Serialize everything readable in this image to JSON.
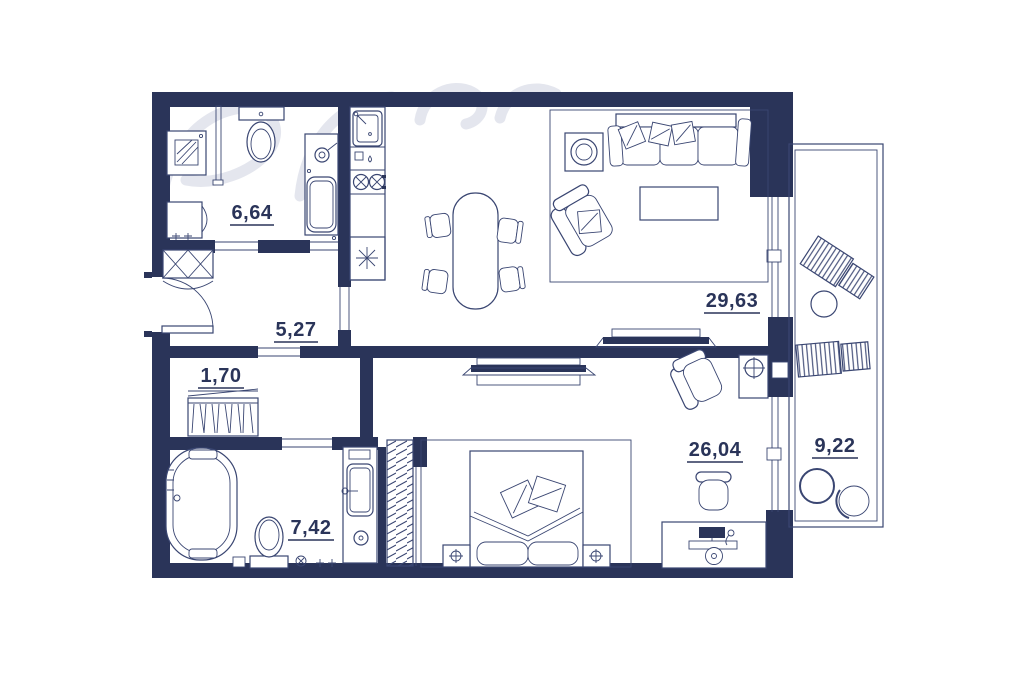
{
  "plan": {
    "title": "apartment-floor-plan",
    "units": "m2",
    "colors": {
      "wall": "#2a3459",
      "line": "#3a4672",
      "label": "#2a3459",
      "watermark": "#c9cedd",
      "background": "#ffffff"
    },
    "rooms": [
      {
        "name": "bathroom-small",
        "area": "6,64",
        "furniture": [
          "washing-machine",
          "toilet",
          "sink-vanity",
          "cabinet"
        ]
      },
      {
        "name": "hallway",
        "area": "5,27",
        "furniture": [
          "shoe-cabinet",
          "entrance-door"
        ]
      },
      {
        "name": "wardrobe-closet",
        "area": "1,70",
        "furniture": [
          "wardrobe-hangers"
        ]
      },
      {
        "name": "bathroom-main",
        "area": "7,42",
        "furniture": [
          "bathtub",
          "toilet",
          "sink-vanity",
          "built-in-wardrobe"
        ]
      },
      {
        "name": "kitchen-living-room",
        "area": "29,63",
        "furniture": [
          "kitchen-sink",
          "stove",
          "refrigerator",
          "dining-table",
          "chairs",
          "sofa",
          "armchair",
          "coffee-table",
          "side-table",
          "tv-console",
          "rug"
        ]
      },
      {
        "name": "bedroom",
        "area": "26,04",
        "furniture": [
          "double-bed",
          "nightstands",
          "armchair",
          "desk",
          "desk-chair",
          "tv-console",
          "ventilation-shaft",
          "rug"
        ]
      },
      {
        "name": "balcony",
        "area": "9,22",
        "furniture": [
          "lounge-chair",
          "lounge-chair",
          "side-table",
          "round-table",
          "chair"
        ]
      }
    ]
  }
}
